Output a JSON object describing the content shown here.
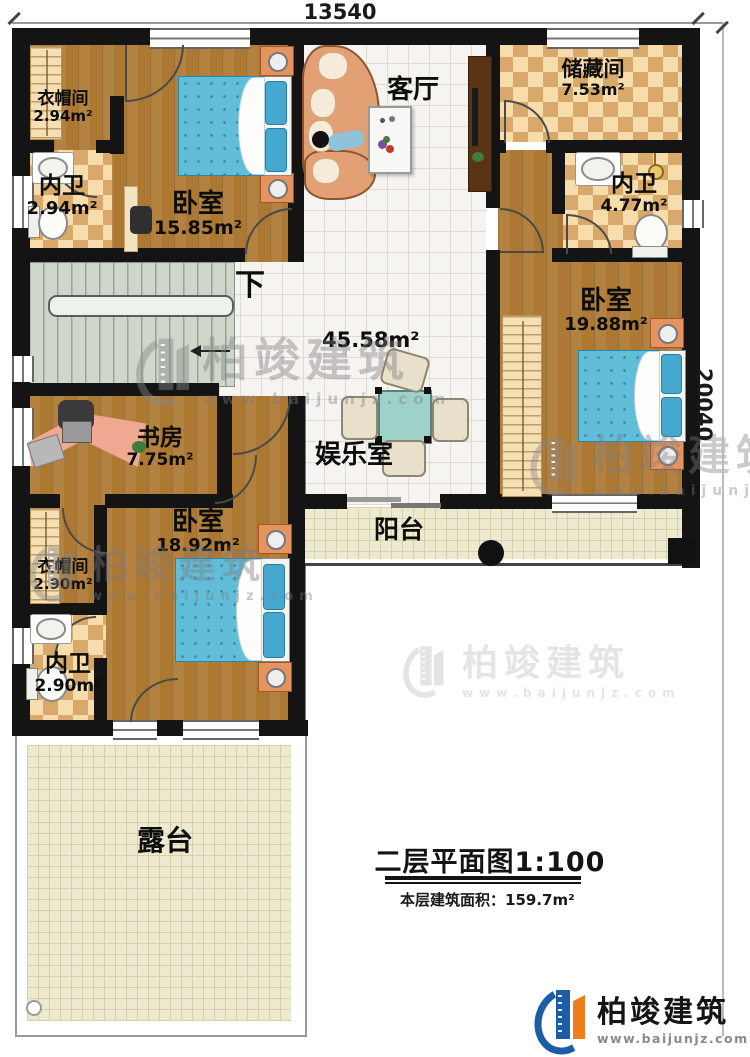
{
  "plan": {
    "dim_width": "13540",
    "dim_height": "20040",
    "stairs_label": "下"
  },
  "rooms": {
    "cloakroom_top": {
      "label": "衣帽间",
      "area": "2.94m²"
    },
    "bath_top": {
      "label": "内卫",
      "area": "2.94m²"
    },
    "bedroom_top": {
      "label": "卧室",
      "area": "15.85m²"
    },
    "living": {
      "label": "客厅"
    },
    "storage": {
      "label": "储藏间",
      "area": "7.53m²"
    },
    "bath_right": {
      "label": "内卫",
      "area": "4.77m²"
    },
    "bedroom_right": {
      "label": "卧室",
      "area": "19.88m²"
    },
    "hall": {
      "area": "45.58m²"
    },
    "game": {
      "label": "娱乐室"
    },
    "study": {
      "label": "书房",
      "area": "7.75m²"
    },
    "bedroom_bottom": {
      "label": "卧室",
      "area": "18.92m²"
    },
    "cloakroom_bottom": {
      "label": "衣帽间",
      "area": "2.90m²"
    },
    "bath_bottom": {
      "label": "内卫",
      "area": "2.90m²"
    },
    "balcony": {
      "label": "阳台"
    },
    "terrace": {
      "label": "露台"
    }
  },
  "title_block": {
    "title": "二层平面图1:100",
    "area_label": "本层建筑面积：",
    "area_value": "159.7m²"
  },
  "branding": {
    "company": "柏竣建筑",
    "website": "www.baijunjz.com"
  },
  "colors": {
    "wall": "#141414",
    "wood": "#ad7832",
    "woodline": "#96661f",
    "tile": "#f6f4f1",
    "tileline": "#dedad4",
    "checka": "#f6ddab",
    "checkb": "#d9a86b",
    "bed": "#62bdd9",
    "beddot": "#2e85a8",
    "pillow": "#45a9cf",
    "stair": "#ced7ca",
    "stairline": "#97a394",
    "outdoor": "#edead0",
    "outdoorline": "#d6d0ac",
    "sofa": "#e2a074",
    "cushion": "#f6ead9",
    "teal": "#9ed2c9",
    "chairbg": "#e9e0cc",
    "nightstand": "#e59460",
    "closet": "#f4e0b4",
    "desk": "#f0a893",
    "logoblue": "#1b5ea6",
    "logoorange": "#ee7d1b"
  }
}
